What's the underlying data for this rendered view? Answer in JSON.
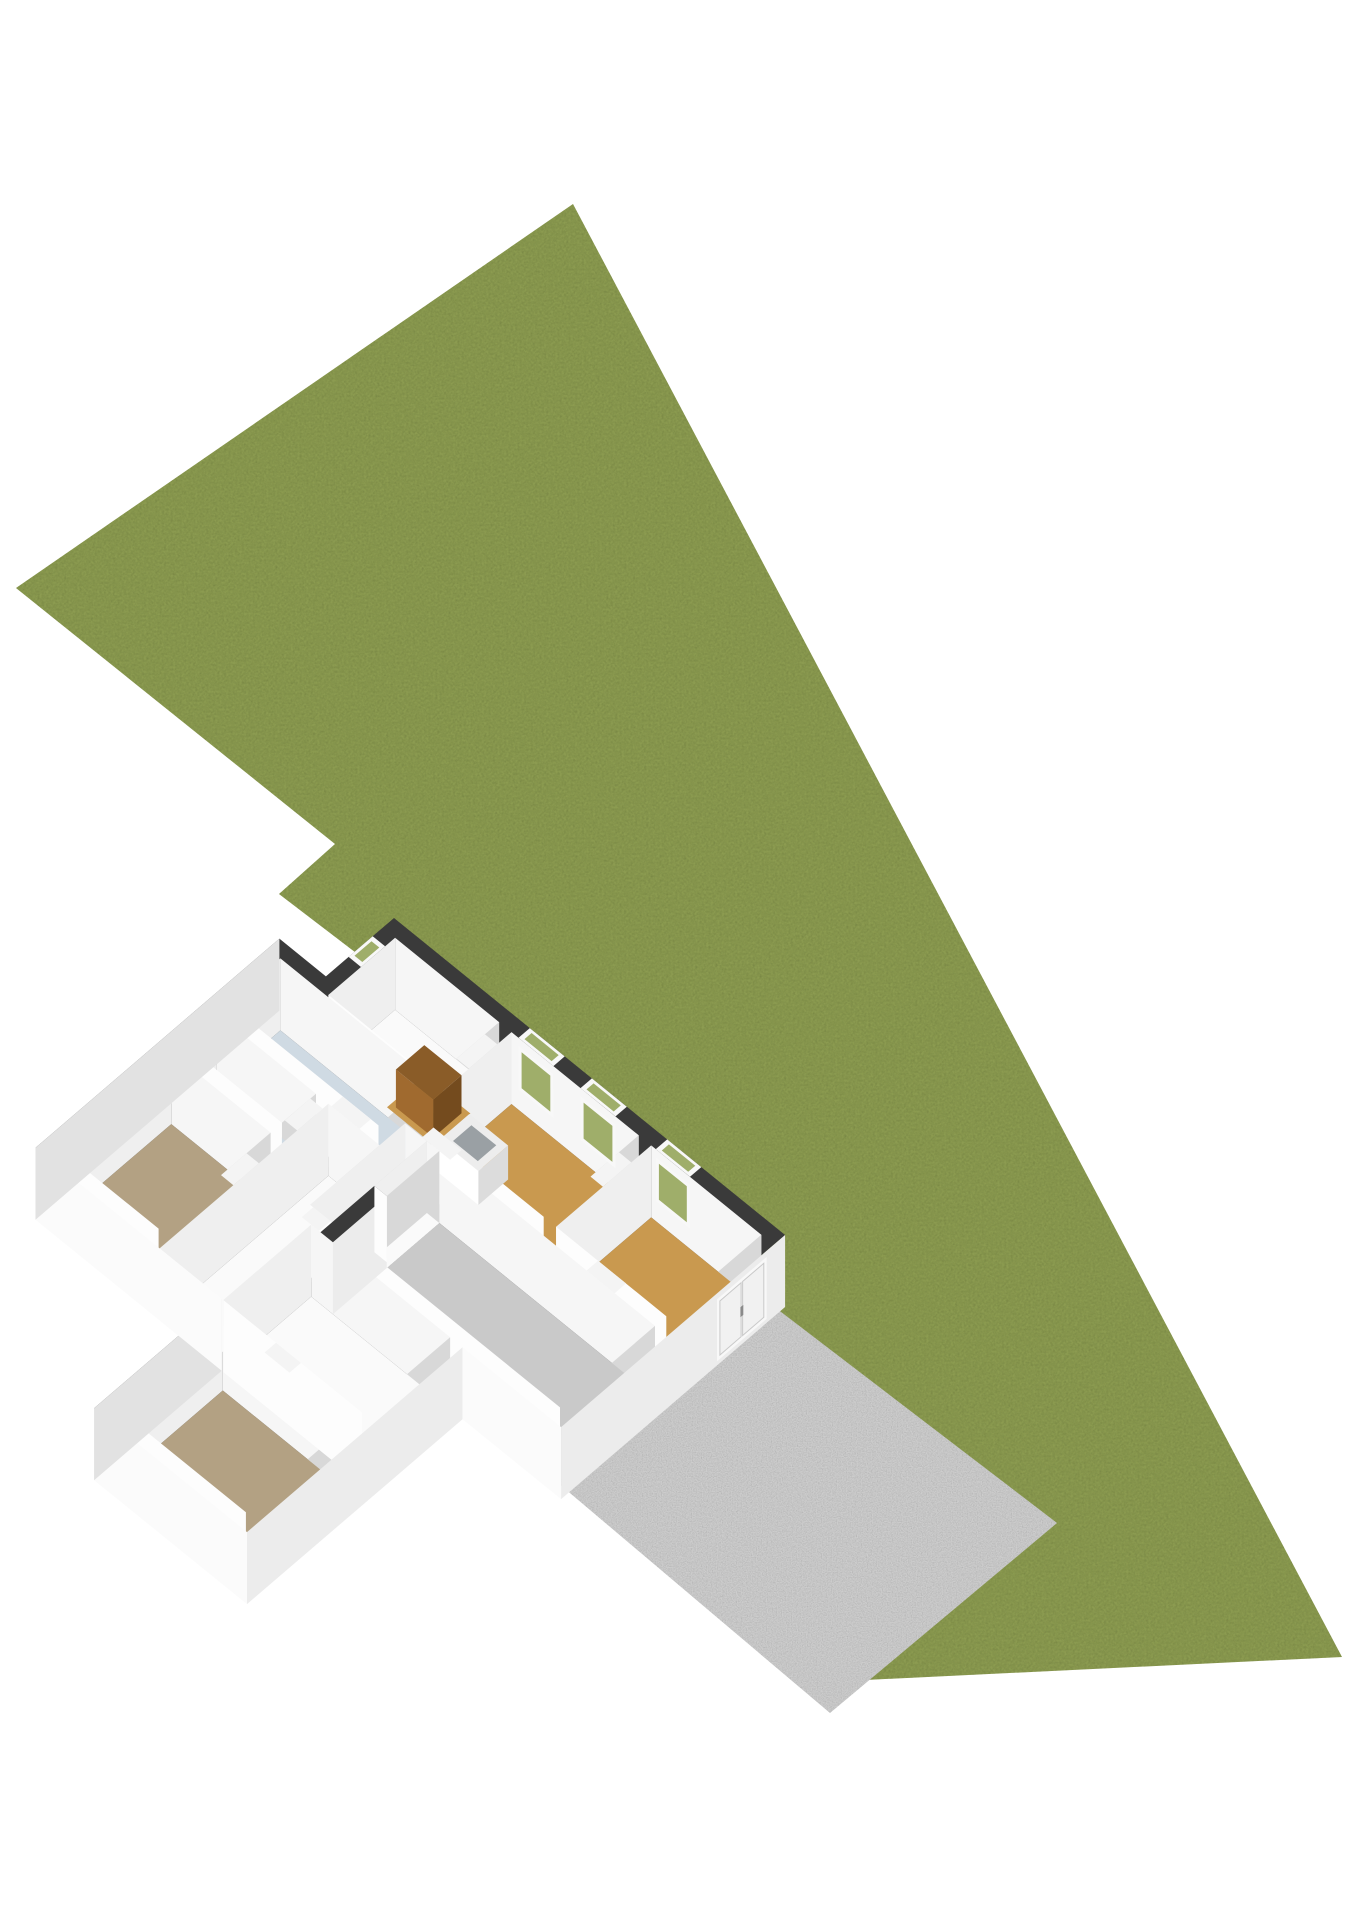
{
  "scene": {
    "type": "3d-floorplan-site-view",
    "description": "Isometric 3D ground-floor plan of a house with cut-away white walls on a large olive-green lot polygon with a concrete terrace at the lower right",
    "canvas": {
      "width": 1358,
      "height": 1920
    },
    "lot": {
      "label": "garden-lot",
      "texture": "grass"
    },
    "terrace": {
      "label": "concrete-terrace",
      "texture": "concrete"
    },
    "house": {
      "label": "house-ground-floor",
      "rooms": [
        {
          "name": "storage-room",
          "floor": "white",
          "furniture": "cabinet"
        },
        {
          "name": "kitchen",
          "floor": "wood",
          "furniture": "sink-counter"
        },
        {
          "name": "middle-room",
          "floor": "wood"
        },
        {
          "name": "living-room",
          "floor": "gray-concrete"
        },
        {
          "name": "bathroom",
          "floor": "light-blue"
        },
        {
          "name": "toilet",
          "floor": "light-blue"
        },
        {
          "name": "bedroom-1",
          "floor": "tan"
        },
        {
          "name": "bedroom-2",
          "floor": "tan"
        },
        {
          "name": "hallway",
          "floor": "white"
        },
        {
          "name": "entry-hall",
          "floor": "white"
        }
      ],
      "windows_ne_wall": 3,
      "windows_nw_wall": 1,
      "sliding-door": "southeast-facade"
    }
  },
  "colors": {
    "background": "#ffffff",
    "grass": "#8c9b51",
    "grassSpeckle": "#5c6a33",
    "patio": "#cdcdcd",
    "patioSpeckle": "#9a9a9a",
    "wallTop": "#3a3a3a",
    "extBright": "#fbfbfb",
    "extSE": "#ececec",
    "extSide": "#e2e2e2",
    "intN": "#f6f6f6",
    "intW": "#efefef",
    "intE": "#d8d8d8",
    "intS": "#fdfdfd",
    "floorWood": "#c9994f",
    "floorTan": "#b3a183",
    "floorBath": "#cfdae3",
    "floorLiving": "#c9c9c9",
    "floorWhite": "#fafafa",
    "glass": "#9fae6a",
    "windowFrame": "#f8f8f8",
    "cabinetTop": "#8a5c28",
    "cabinetFront": "#a06a2f",
    "cabinetSide": "#744b1e",
    "counterTop": "#ededed",
    "counterFront": "#ffffff",
    "counterSide": "#dcdcdc",
    "sinkBasin": "#9aa0a4",
    "doorSeam": "#c9c9c9"
  }
}
